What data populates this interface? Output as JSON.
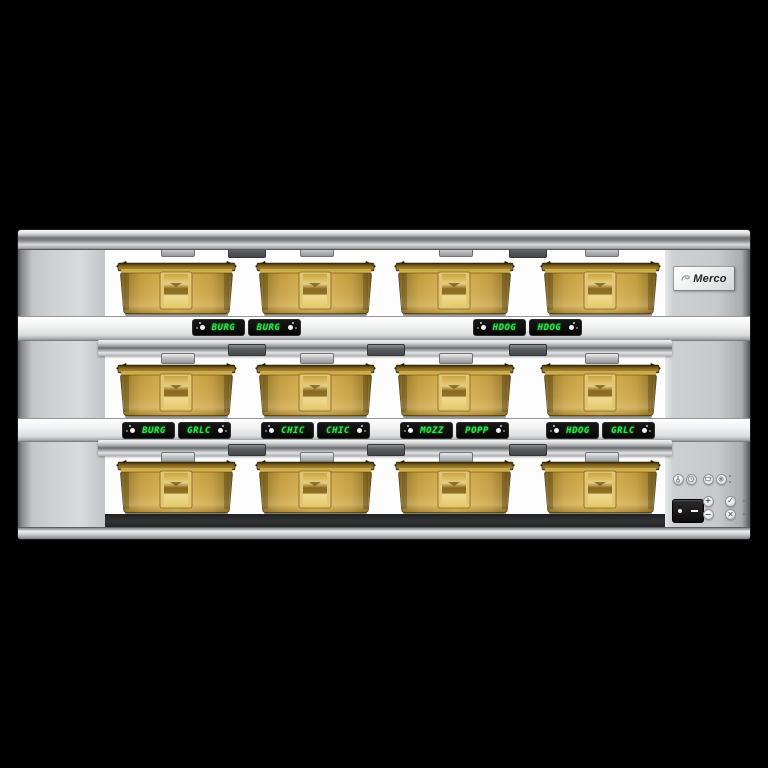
{
  "brand": {
    "name": "Merco"
  },
  "colors": {
    "background": "#000000",
    "led_green": "#2FE24C",
    "pan_amber": "#D9B452",
    "steel_silver": "#C9CCCE"
  },
  "shelves": [
    {
      "id": "top",
      "pan_count": 4,
      "displays": [
        {
          "anchor": "gap-1",
          "modules": [
            {
              "text": "BURG",
              "icon_side": "left"
            },
            {
              "text": "BURG",
              "icon_side": "right"
            }
          ]
        },
        {
          "anchor": "gap-3",
          "modules": [
            {
              "text": "HDOG",
              "icon_side": "left"
            },
            {
              "text": "HDOG",
              "icon_side": "right"
            }
          ]
        }
      ]
    },
    {
      "id": "middle",
      "pan_count": 4,
      "displays": [
        {
          "anchor": "pan-1",
          "modules": [
            {
              "text": "BURG",
              "icon_side": "left"
            },
            {
              "text": "GRLC",
              "icon_side": "right"
            }
          ]
        },
        {
          "anchor": "pan-2",
          "modules": [
            {
              "text": "CHIC",
              "icon_side": "left"
            },
            {
              "text": "CHIC",
              "icon_side": "right"
            }
          ]
        },
        {
          "anchor": "pan-3",
          "modules": [
            {
              "text": "MOZZ",
              "icon_side": "left"
            },
            {
              "text": "POPP",
              "icon_side": "right"
            }
          ]
        },
        {
          "anchor": "pan-4",
          "modules": [
            {
              "text": "HDOG",
              "icon_side": "left"
            },
            {
              "text": "GRLC",
              "icon_side": "right"
            }
          ]
        }
      ]
    },
    {
      "id": "bottom",
      "pan_count": 4,
      "displays": []
    }
  ],
  "control_panel": {
    "mode_buttons": [
      {
        "icon": "thermometer-icon"
      },
      {
        "icon": "clock-icon"
      },
      {
        "icon": "pan-icon"
      },
      {
        "icon": "cleaning-icon"
      }
    ],
    "adjust_buttons": {
      "plus": "+",
      "minus": "−",
      "confirm": "✓",
      "cancel": "✕"
    },
    "power_switch": {
      "type": "rocker"
    }
  }
}
